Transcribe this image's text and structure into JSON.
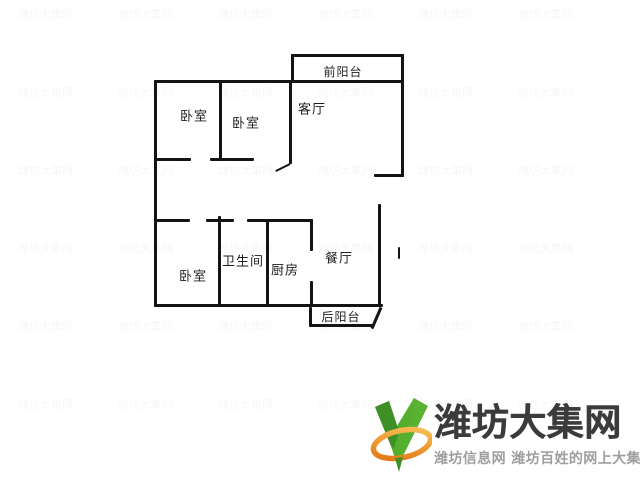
{
  "floorplan": {
    "ink_color": "#141414",
    "label_color": "#1e1e1e",
    "rooms": [
      {
        "name": "front-balcony-label",
        "label": "前阳台",
        "cx": 343,
        "cy": 72,
        "fs": 12
      },
      {
        "name": "bedroom-top-left-label",
        "label": "卧室",
        "cx": 194,
        "cy": 117,
        "fs": 13
      },
      {
        "name": "bedroom-top-mid-label",
        "label": "卧室",
        "cx": 246,
        "cy": 124,
        "fs": 13
      },
      {
        "name": "living-room-label",
        "label": "客厅",
        "cx": 312,
        "cy": 110,
        "fs": 13
      },
      {
        "name": "bedroom-bottom-left-label",
        "label": "卧室",
        "cx": 193,
        "cy": 277,
        "fs": 13
      },
      {
        "name": "bathroom-label",
        "label": "卫生间",
        "cx": 243,
        "cy": 262,
        "fs": 13
      },
      {
        "name": "kitchen-label",
        "label": "厨房",
        "cx": 285,
        "cy": 271,
        "fs": 13
      },
      {
        "name": "dining-room-label",
        "label": "餐厅",
        "cx": 339,
        "cy": 259,
        "fs": 13
      },
      {
        "name": "back-balcony-label",
        "label": "后阳台",
        "cx": 341,
        "cy": 317,
        "fs": 12
      }
    ],
    "walls": [
      {
        "name": "front-balcony-top-wall",
        "x": 291,
        "y": 54,
        "w": 113,
        "h": 3
      },
      {
        "name": "front-balcony-left-wall",
        "x": 291,
        "y": 54,
        "w": 3,
        "h": 29
      },
      {
        "name": "top-outer-wall",
        "x": 154,
        "y": 80,
        "w": 250,
        "h": 3
      },
      {
        "name": "left-outer-wall",
        "x": 154,
        "y": 80,
        "w": 3,
        "h": 227
      },
      {
        "name": "right-outer-wall-upper",
        "x": 401,
        "y": 54,
        "w": 3,
        "h": 123
      },
      {
        "name": "living-room-bottom-wall",
        "x": 374,
        "y": 174,
        "w": 30,
        "h": 3
      },
      {
        "name": "bedrooms-divider-wall",
        "x": 219,
        "y": 80,
        "w": 3,
        "h": 81
      },
      {
        "name": "living-room-left-wall",
        "x": 289,
        "y": 80,
        "w": 3,
        "h": 84
      },
      {
        "name": "hall-wall-left",
        "x": 154,
        "y": 158,
        "w": 37,
        "h": 3
      },
      {
        "name": "hall-wall-mid",
        "x": 210,
        "y": 158,
        "w": 44,
        "h": 3
      },
      {
        "name": "lower-top-wall-left",
        "x": 154,
        "y": 219,
        "w": 36,
        "h": 3
      },
      {
        "name": "lower-top-wall-mid",
        "x": 206,
        "y": 219,
        "w": 28,
        "h": 3
      },
      {
        "name": "lower-top-wall-right",
        "x": 247,
        "y": 219,
        "w": 66,
        "h": 3
      },
      {
        "name": "bathroom-left-wall",
        "x": 218,
        "y": 216,
        "w": 3,
        "h": 91
      },
      {
        "name": "kitchen-left-wall",
        "x": 266,
        "y": 220,
        "w": 3,
        "h": 87
      },
      {
        "name": "kitchen-right-wall-upper",
        "x": 310,
        "y": 219,
        "w": 3,
        "h": 32
      },
      {
        "name": "kitchen-right-wall-lower",
        "x": 310,
        "y": 281,
        "w": 3,
        "h": 26
      },
      {
        "name": "dining-right-wall",
        "x": 378,
        "y": 204,
        "w": 3,
        "h": 103
      },
      {
        "name": "bottom-outer-wall",
        "x": 154,
        "y": 304,
        "w": 229,
        "h": 3
      },
      {
        "name": "back-balcony-left-wall",
        "x": 309,
        "y": 307,
        "w": 3,
        "h": 19
      },
      {
        "name": "back-balcony-bottom-wall",
        "x": 309,
        "y": 324,
        "w": 65,
        "h": 3
      },
      {
        "name": "door-mark",
        "x": 398,
        "y": 247,
        "w": 2,
        "h": 12
      }
    ],
    "diagonals": [
      {
        "name": "living-room-door-leaf",
        "x1": 290,
        "y1": 163,
        "x2": 276,
        "y2": 170,
        "t": 2
      },
      {
        "name": "back-balcony-right-wall",
        "x1": 381,
        "y1": 306,
        "x2": 372,
        "y2": 327,
        "t": 3
      }
    ]
  },
  "watermark": {
    "text": "潍坊大集网",
    "opacity": 0.03,
    "cols": [
      18,
      118,
      218,
      318,
      418,
      518
    ],
    "rows": [
      6,
      84,
      162,
      240,
      318,
      396
    ]
  },
  "logo": {
    "title": "潍坊大集网",
    "tagline": "潍坊信息网 潍坊百姓的网上大集",
    "title_color": "#3b3b3b",
    "tagline_color": "#9e9e9e",
    "icon": {
      "green_light": "#5cb531",
      "green_mid": "#4da32c",
      "green_dark": "#3f8f27",
      "orange_light": "#fbc256",
      "orange_mid": "#f29c1f",
      "orange_dark": "#e07514"
    }
  }
}
